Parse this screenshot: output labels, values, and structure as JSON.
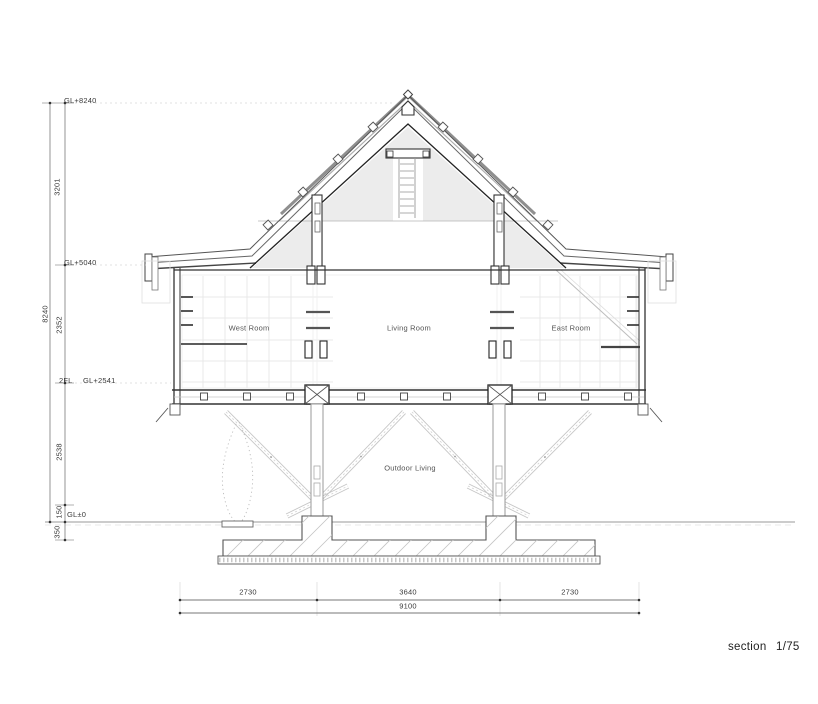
{
  "drawing": {
    "name": "section",
    "scale": "1/75",
    "levels": {
      "gl8240": "GL+8240",
      "gl5040": "GL+5040",
      "fl2": "2FL",
      "gl2541": "GL+2541",
      "gl0": "GL±0"
    },
    "vertical_dims": {
      "d3201": "3201",
      "d8240": "8240",
      "d2352": "2352",
      "d2538": "2538",
      "d150": "150",
      "d350": "350"
    },
    "horizontal_dims": {
      "left": "2730",
      "center": "3640",
      "right": "2730",
      "total": "9100"
    },
    "rooms": {
      "west": "West Room",
      "living": "Living Room",
      "east": "East Room",
      "outdoor": "Outdoor Living"
    },
    "colors": {
      "line_dark": "#333333",
      "line_mid": "#666666",
      "line_light": "#c9c9c9",
      "grid": "#e3e3e3",
      "roof_skin": "#8f8f8f",
      "fill_gable": "#ececec",
      "background": "#ffffff"
    }
  }
}
